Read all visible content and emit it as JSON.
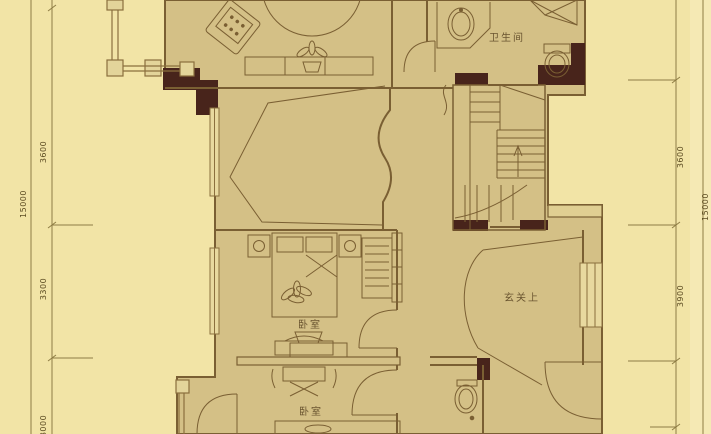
{
  "plan": {
    "rooms": {
      "bathroom_top": {
        "label": "卫生间"
      },
      "foyer_void": {
        "label": "玄关上"
      },
      "bedroom_mid": {
        "label": "卧室"
      },
      "bedroom_bottom": {
        "label": "卧室"
      }
    },
    "dimensions": {
      "left_total": "15000",
      "left_seg_1": "3600",
      "left_seg_2": "3300",
      "left_seg_3": "3000",
      "right_seg_1": "3600",
      "right_seg_2": "3900",
      "right_total": "15000"
    },
    "colors": {
      "background": "#f2e4a6",
      "floor": "#d4c086",
      "wall_dark": "#48241b",
      "line": "#7a5f33",
      "window_fill": "#e8d99f",
      "dimension_line": "#8f7d45",
      "dimension_text": "#5c4c22"
    }
  }
}
